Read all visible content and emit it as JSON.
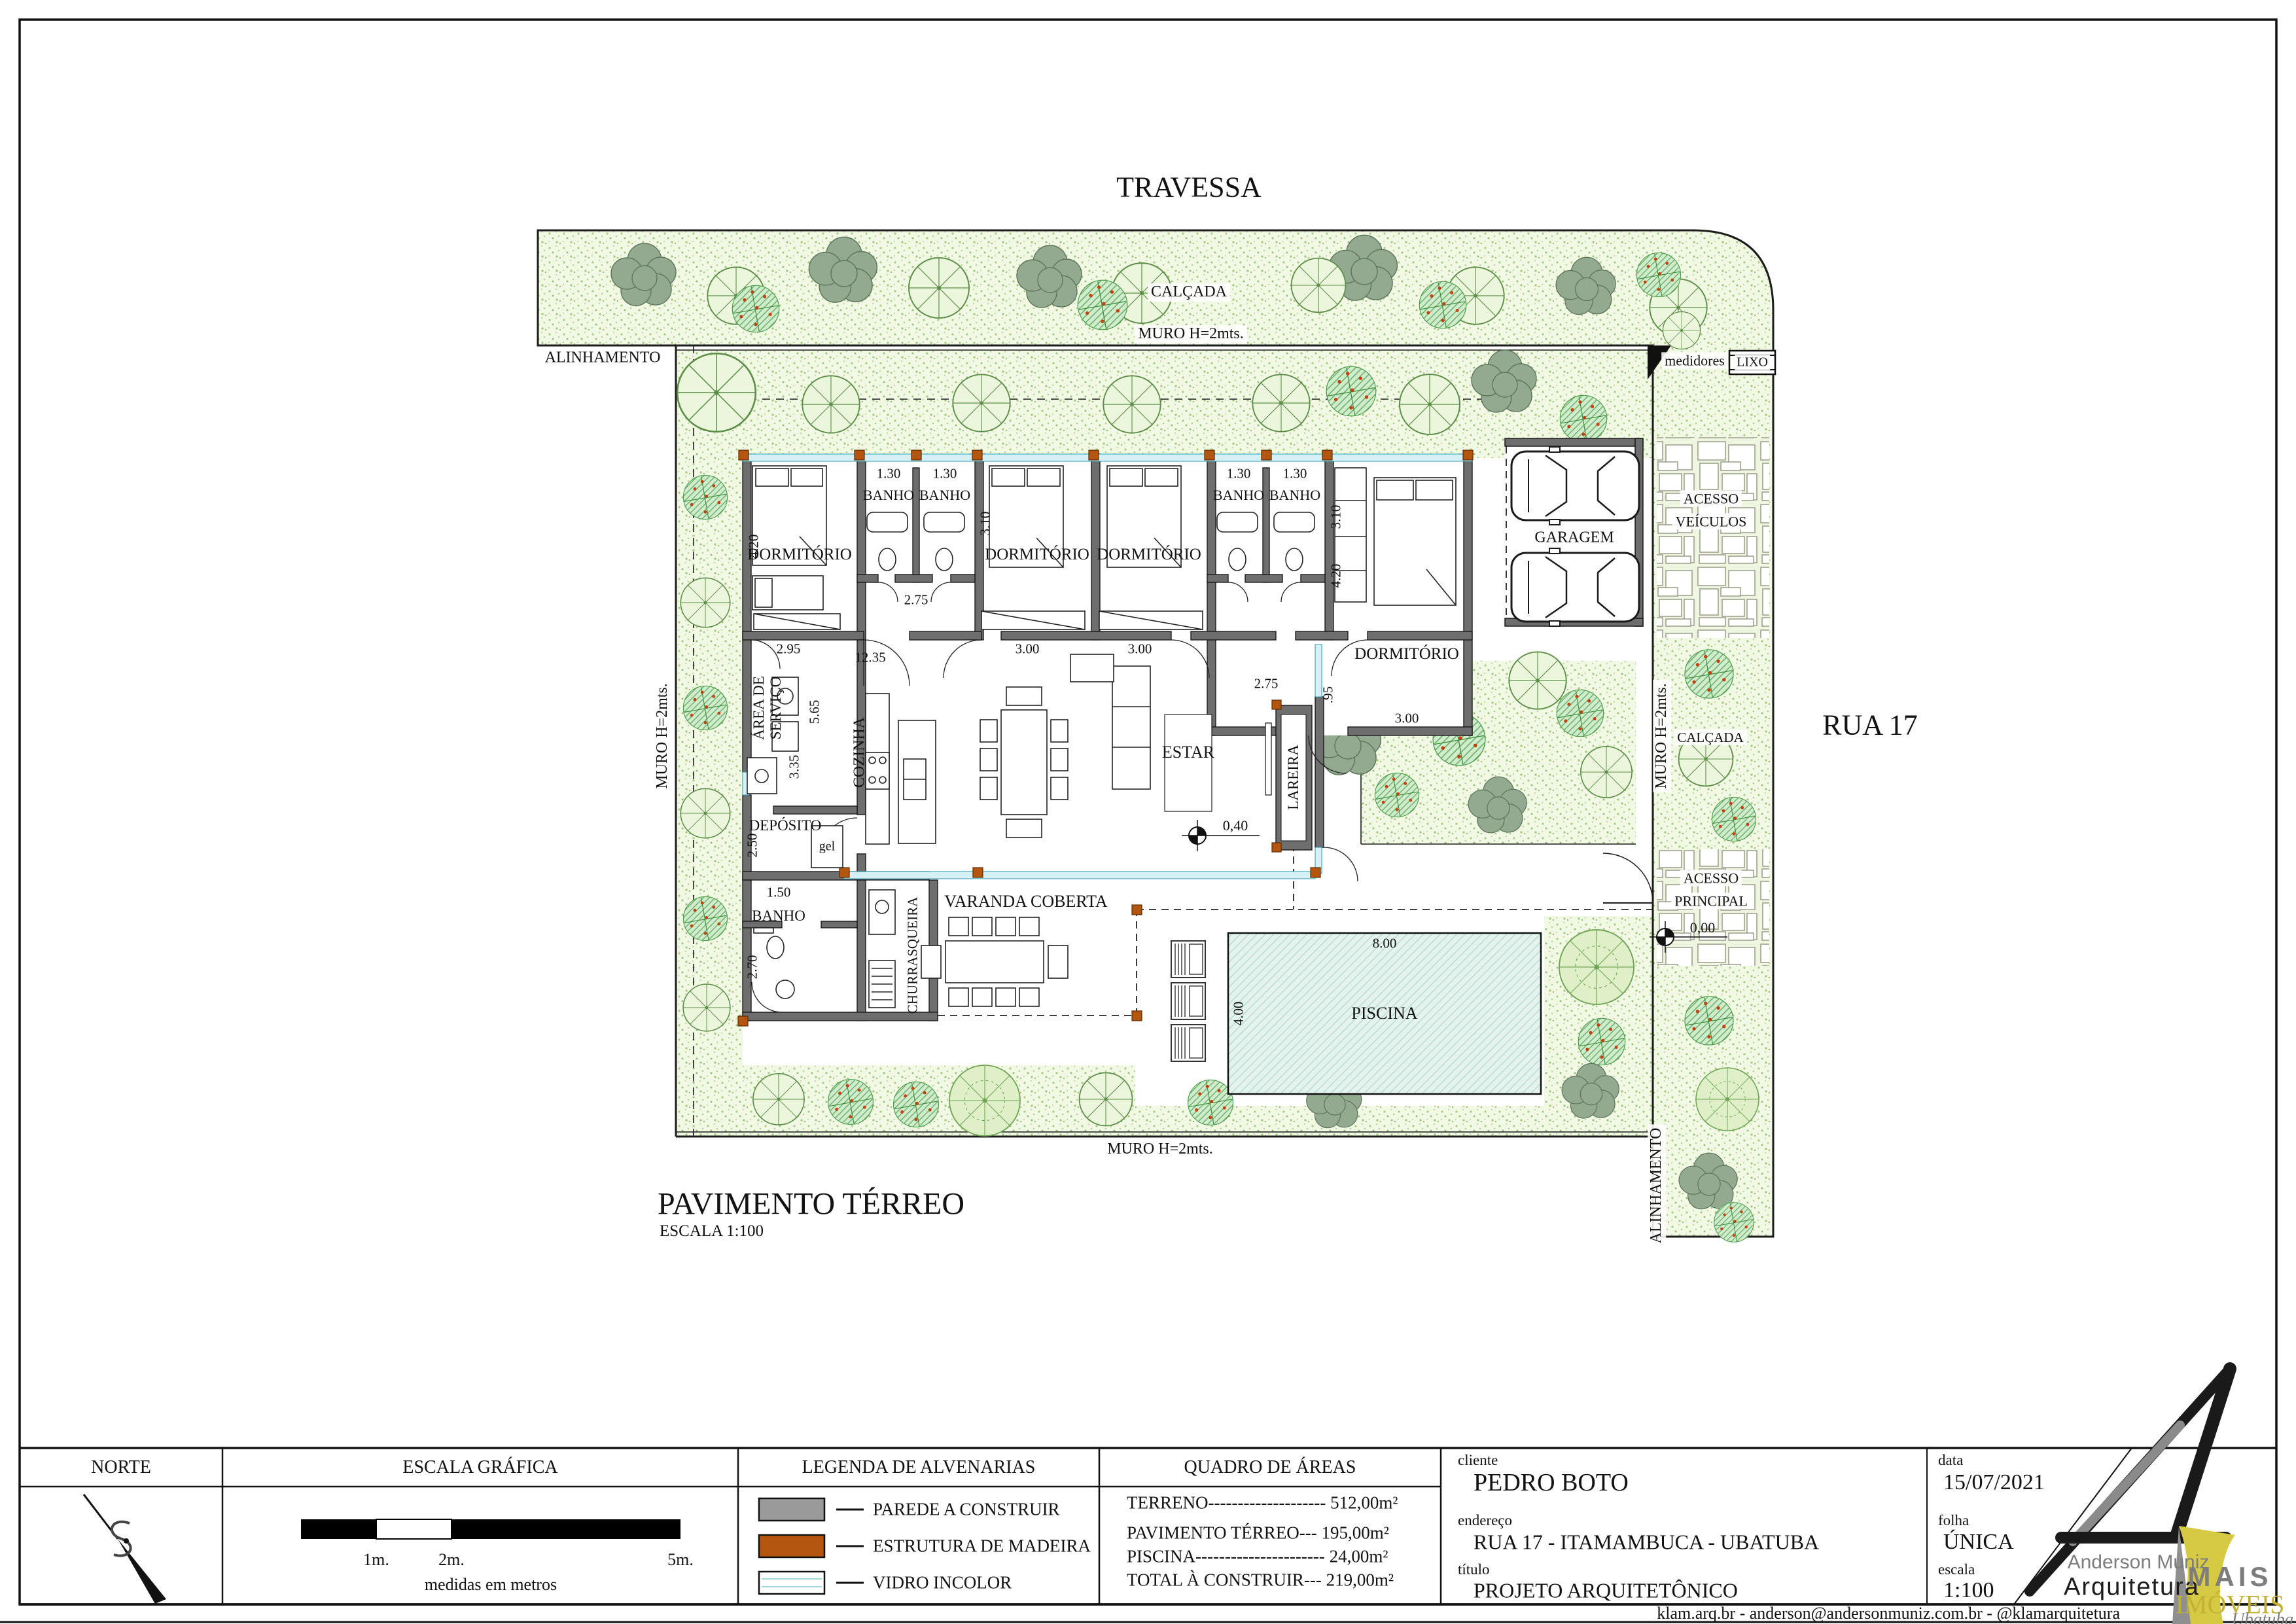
{
  "drawing": {
    "street_top": "TRAVESSA",
    "street_right": "RUA 17",
    "calcada": "CALÇADA",
    "muro": "MURO H=2mts.",
    "alinhamento": "ALINHAMENTO",
    "medidores": "medidores",
    "lixo": "LIXO",
    "acesso": "ACESSO",
    "veiculos": "VEÍCULOS",
    "principal": "PRINCIPAL",
    "plan_title": "PAVIMENTO TÉRREO",
    "plan_scale": "ESCALA 1:100"
  },
  "rooms": {
    "dormitorio": "DORMITÓRIO",
    "banho": "BANHO",
    "garagem": "GARAGEM",
    "cozinha": "COZINHA",
    "area1": "ÁREA DE",
    "area2": "SERVIÇO",
    "deposito": "DEPÓSITO",
    "gel": "gel",
    "estar": "ESTAR",
    "lareira": "LAREIRA",
    "churrasqueira": "CHURRASQUEIRA",
    "varanda": "VARANDA COBERTA",
    "piscina": "PISCINA"
  },
  "dims": {
    "b130": "1.30",
    "d310": "3.10",
    "d420": "4.20",
    "d275": "2.75",
    "d295": "2.95",
    "d300": "3.00",
    "d1235": "12.35",
    "d565": "5.65",
    "d335": "3.35",
    "d250": "2.50",
    "d150": "1.50",
    "d270": "2.70",
    "d095": ".95",
    "d800": "8.00",
    "d400": "4.00",
    "lvl040": "0,40",
    "lvl000": "0,00"
  },
  "titleblock": {
    "norte": "NORTE",
    "escala_grafica": "ESCALA GRÁFICA",
    "tick1": "1m.",
    "tick2": "2m.",
    "tick5": "5m.",
    "medidas": "medidas em metros",
    "legenda": "LEGENDA DE ALVENARIAS",
    "leg_parede": "PAREDE A CONSTRUIR",
    "leg_madeira": "ESTRUTURA DE MADEIRA",
    "leg_vidro": "VIDRO INCOLOR",
    "quadro": "QUADRO DE ÁREAS",
    "rows": [
      "TERRENO-------------------- 512,00m²",
      "PAVIMENTO TÉRREO--- 195,00m²",
      "PISCINA---------------------- 24,00m²",
      "TOTAL À CONSTRUIR--- 219,00m²"
    ],
    "cliente_label": "cliente",
    "cliente": "PEDRO BOTO",
    "endereco_label": "endereço",
    "endereco": "RUA 17 - ITAMAMBUCA - UBATUBA",
    "titulo_label": "título",
    "titulo": "PROJETO ARQUITETÔNICO",
    "data_label": "data",
    "data": "15/07/2021",
    "folha_label": "folha",
    "folha": "ÚNICA",
    "escala_label": "escala",
    "escala": "1:100",
    "colors": {
      "parede": "#9a9a9a",
      "madeira": "#b4560f",
      "vidro": "#eaf7f8"
    }
  },
  "logo": {
    "name1": "Anderson Muniz",
    "name2": "Arquitetura",
    "mais": "MAIS",
    "imoveis": "IMÓVEIS",
    "ubatuba": "Ubatuba"
  },
  "footer": "klam.arq.br - anderson@andersonmuniz.com.br - @klamarquitetura"
}
